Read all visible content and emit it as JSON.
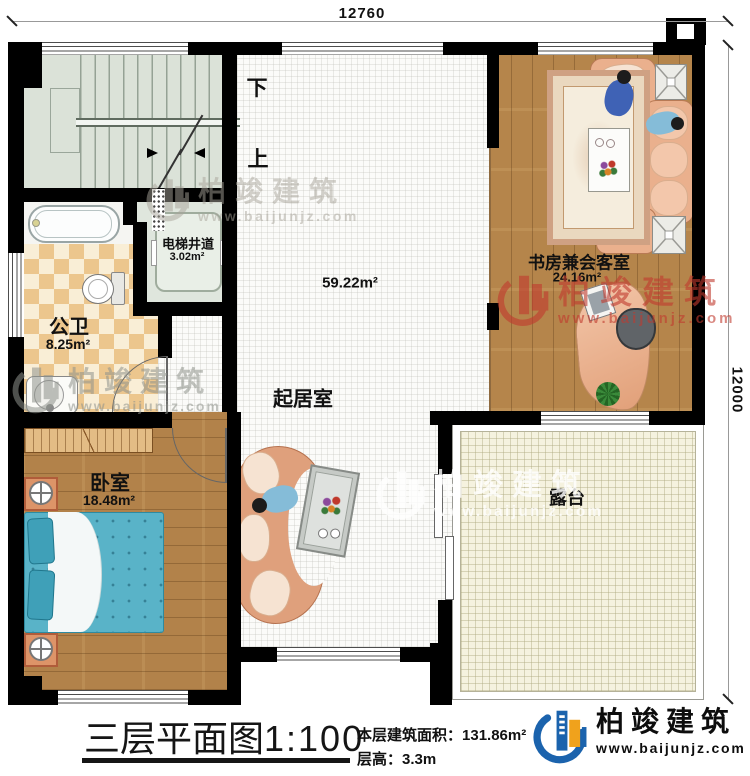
{
  "dimensions": {
    "top_width": "12760",
    "right_height": "12000"
  },
  "stairwell": {
    "down_label": "下",
    "up_label": "上"
  },
  "rooms": {
    "elevator": {
      "name": "电梯井道",
      "area": "3.02m²"
    },
    "bathroom": {
      "name": "公卫",
      "area": "8.25m²"
    },
    "living_room": {
      "name": "起居室",
      "area": "59.22m²"
    },
    "study": {
      "name": "书房兼会客室",
      "area": "24.16m²"
    },
    "bedroom": {
      "name": "卧室",
      "area": "18.48m²"
    },
    "terrace": {
      "name": "露台"
    }
  },
  "footer": {
    "plan_title": "三层平面图",
    "plan_scale": "1:100",
    "floor_area_label": "本层建筑面积：",
    "floor_area_value": "131.86m²",
    "floor_height_label": "层高：",
    "floor_height_value": "3.3m"
  },
  "brand": {
    "name": "柏竣建筑",
    "website": "www.baijunjz.com",
    "blue": "#1b63ad",
    "orange": "#f0a21c"
  },
  "watermark": {
    "name": "柏竣建筑",
    "url": "www.baijunjz.com"
  }
}
